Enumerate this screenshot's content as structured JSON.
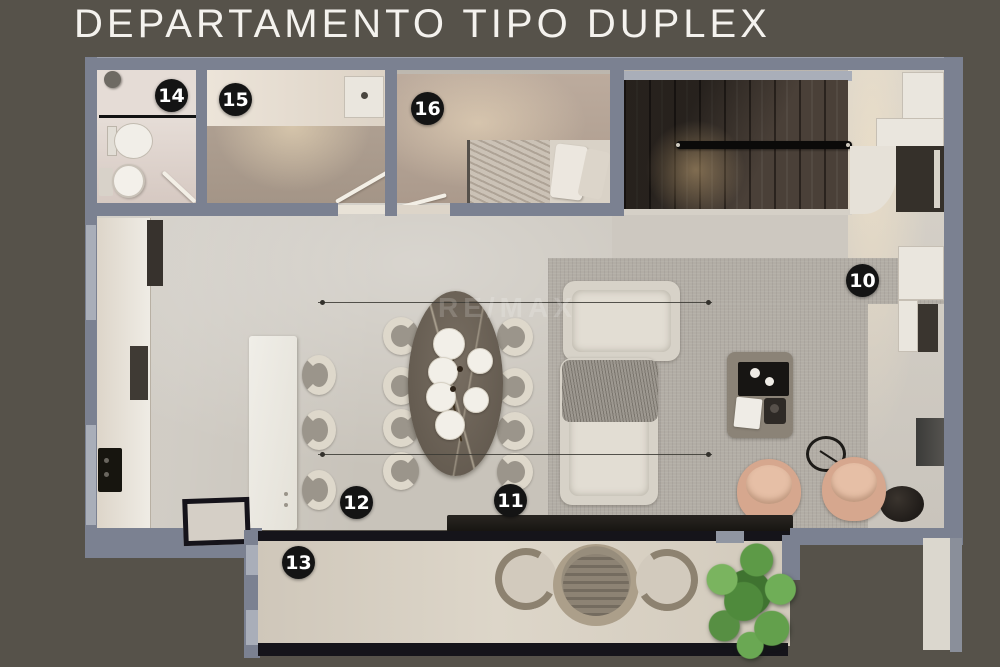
{
  "title": "DEPARTAMENTO TIPO DUPLEX",
  "watermark": "RE/MAX",
  "labels": [
    {
      "num": "10"
    },
    {
      "num": "11"
    },
    {
      "num": "12"
    },
    {
      "num": "13"
    },
    {
      "num": "14"
    },
    {
      "num": "15"
    },
    {
      "num": "16"
    }
  ],
  "colors": {
    "background": "#56524a",
    "wall": "#7b8191",
    "floor": "#c8c3ba",
    "stairs_wood": "#4a4038",
    "rug": "#b2ada5",
    "label_bg": "#141414",
    "label_text": "#ffffff",
    "title_text": "#f4f2ee",
    "tree_green": "#4f8a3c",
    "armchair": "#d6a78e"
  }
}
